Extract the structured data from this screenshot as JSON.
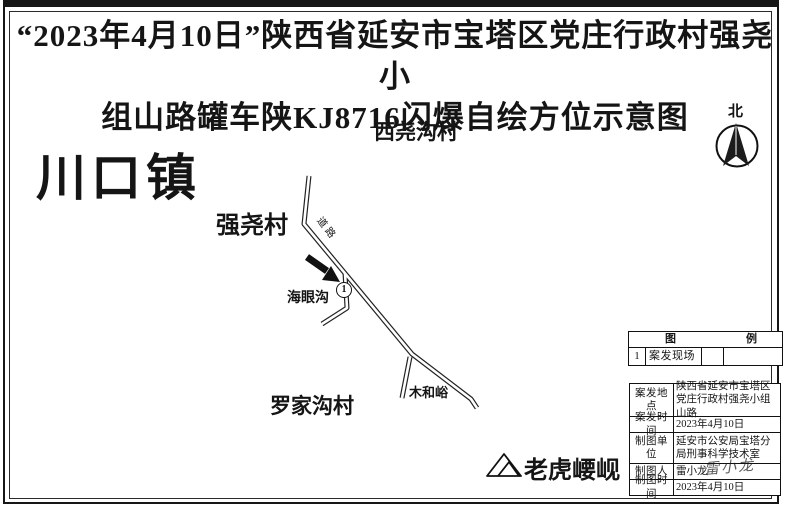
{
  "title": {
    "line1": "“2023年4月10日”陕西省延安市宝塔区党庄行政村强尧小",
    "line2": "组山路罐车陕KJ8716闪爆自绘方位示意图"
  },
  "compass": {
    "north_label": "北"
  },
  "map": {
    "town_label": "川口镇",
    "village_top": "西尧沟村",
    "village_left": "强尧村",
    "gully_label": "海眼沟",
    "village_bottom": "罗家沟村",
    "junction_label": "木和峪",
    "mountain_label": "老虎崾岘",
    "road_label": "道路",
    "incident_marker_number": "1"
  },
  "legend": {
    "header_left": "图",
    "header_right": "例",
    "rows": [
      {
        "no": "1",
        "desc": "案发现场",
        "symbol": "",
        "note": ""
      }
    ]
  },
  "info_table": {
    "rows": [
      {
        "label": "案发地点",
        "value": "陕西省延安市宝塔区党庄行政村强尧小组山路"
      },
      {
        "label": "案发时间",
        "value": "2023年4月10日"
      },
      {
        "label": "制图单位",
        "value": "延安市公安局宝塔分局刑事科学技术室"
      },
      {
        "label": "制图人",
        "value": "雷小龙"
      },
      {
        "label": "制图时间",
        "value": "2023年4月10日"
      }
    ],
    "signature": "雷小龙"
  },
  "colors": {
    "ink": "#1a1a1a",
    "paper": "#ffffff"
  }
}
